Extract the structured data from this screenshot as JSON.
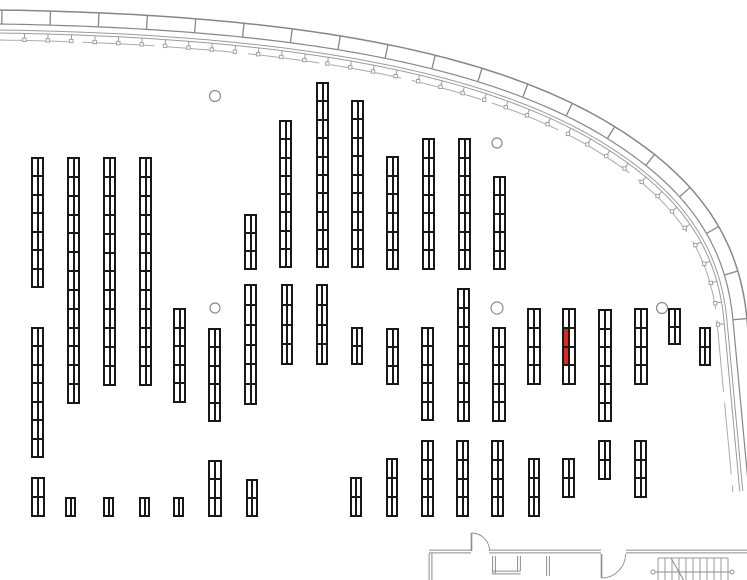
{
  "canvas": {
    "width": 747,
    "height": 580,
    "background": "#ffffff"
  },
  "colors": {
    "rack_line": "#181818",
    "highlight_red": "#dd2a1e",
    "wall_gray": "#8c8c8c",
    "facade_gray": "#878787",
    "facade_thin_gray": "#9b9b9b",
    "facade_inner_gray": "#ababab",
    "stairs_gray": "#9a9a9a"
  },
  "floorplan": {
    "racks": [
      {
        "x": 31,
        "y": 157,
        "w": 13,
        "h": 131,
        "rows": 7
      },
      {
        "x": 67,
        "y": 157,
        "w": 13,
        "h": 247,
        "rows": 13
      },
      {
        "x": 103,
        "y": 157,
        "w": 13,
        "h": 229,
        "rows": 12
      },
      {
        "x": 139,
        "y": 157,
        "w": 13,
        "h": 229,
        "rows": 12
      },
      {
        "x": 31,
        "y": 327,
        "w": 13,
        "h": 131,
        "rows": 7
      },
      {
        "x": 31,
        "y": 477,
        "w": 14,
        "h": 40,
        "rows": 2
      },
      {
        "x": 65,
        "y": 497,
        "w": 11,
        "h": 20,
        "rows": 1
      },
      {
        "x": 103,
        "y": 497,
        "w": 11,
        "h": 20,
        "rows": 1
      },
      {
        "x": 139,
        "y": 497,
        "w": 11,
        "h": 20,
        "rows": 1
      },
      {
        "x": 173,
        "y": 497,
        "w": 11,
        "h": 20,
        "rows": 1
      },
      {
        "x": 173,
        "y": 308,
        "w": 13,
        "h": 95,
        "rows": 5
      },
      {
        "x": 208,
        "y": 328,
        "w": 13,
        "h": 94,
        "rows": 5
      },
      {
        "x": 208,
        "y": 460,
        "w": 14,
        "h": 57,
        "rows": 3
      },
      {
        "x": 244,
        "y": 214,
        "w": 13,
        "h": 56,
        "rows": 3
      },
      {
        "x": 244,
        "y": 284,
        "w": 13,
        "h": 121,
        "rows": 6
      },
      {
        "x": 246,
        "y": 479,
        "w": 12,
        "h": 38,
        "rows": 2
      },
      {
        "x": 279,
        "y": 120,
        "w": 13,
        "h": 148,
        "rows": 8
      },
      {
        "x": 281,
        "y": 284,
        "w": 12,
        "h": 81,
        "rows": 4
      },
      {
        "x": 316,
        "y": 82,
        "w": 13,
        "h": 186,
        "rows": 10
      },
      {
        "x": 316,
        "y": 284,
        "w": 12,
        "h": 81,
        "rows": 4
      },
      {
        "x": 351,
        "y": 100,
        "w": 13,
        "h": 168,
        "rows": 9
      },
      {
        "x": 351,
        "y": 327,
        "w": 12,
        "h": 38,
        "rows": 2
      },
      {
        "x": 350,
        "y": 477,
        "w": 12,
        "h": 40,
        "rows": 2
      },
      {
        "x": 386,
        "y": 156,
        "w": 13,
        "h": 114,
        "rows": 6
      },
      {
        "x": 422,
        "y": 138,
        "w": 13,
        "h": 132,
        "rows": 7
      },
      {
        "x": 458,
        "y": 138,
        "w": 13,
        "h": 132,
        "rows": 7
      },
      {
        "x": 493,
        "y": 176,
        "w": 13,
        "h": 94,
        "rows": 5
      },
      {
        "x": 386,
        "y": 328,
        "w": 13,
        "h": 57,
        "rows": 3
      },
      {
        "x": 421,
        "y": 327,
        "w": 13,
        "h": 94,
        "rows": 5
      },
      {
        "x": 457,
        "y": 288,
        "w": 13,
        "h": 134,
        "rows": 7
      },
      {
        "x": 492,
        "y": 327,
        "w": 14,
        "h": 95,
        "rows": 5
      },
      {
        "x": 527,
        "y": 308,
        "w": 14,
        "h": 77,
        "rows": 4
      },
      {
        "x": 562,
        "y": 308,
        "w": 14,
        "h": 77,
        "rows": 4,
        "highlight_cells": [
          2,
          4
        ]
      },
      {
        "x": 598,
        "y": 309,
        "w": 14,
        "h": 113,
        "rows": 6
      },
      {
        "x": 634,
        "y": 308,
        "w": 14,
        "h": 77,
        "rows": 4
      },
      {
        "x": 668,
        "y": 308,
        "w": 13,
        "h": 37,
        "rows": 2
      },
      {
        "x": 699,
        "y": 327,
        "w": 12,
        "h": 39,
        "rows": 2
      },
      {
        "x": 386,
        "y": 458,
        "w": 12,
        "h": 59,
        "rows": 3
      },
      {
        "x": 421,
        "y": 440,
        "w": 13,
        "h": 77,
        "rows": 4
      },
      {
        "x": 456,
        "y": 440,
        "w": 13,
        "h": 77,
        "rows": 4
      },
      {
        "x": 491,
        "y": 440,
        "w": 13,
        "h": 77,
        "rows": 4
      },
      {
        "x": 528,
        "y": 458,
        "w": 12,
        "h": 59,
        "rows": 3
      },
      {
        "x": 562,
        "y": 458,
        "w": 13,
        "h": 40,
        "rows": 2
      },
      {
        "x": 598,
        "y": 440,
        "w": 13,
        "h": 40,
        "rows": 2
      },
      {
        "x": 634,
        "y": 440,
        "w": 13,
        "h": 58,
        "rows": 3
      }
    ],
    "columns": [
      {
        "cx": 215,
        "cy": 96,
        "r": 5.5
      },
      {
        "cx": 497,
        "cy": 143,
        "r": 5
      },
      {
        "cx": 215,
        "cy": 308,
        "r": 5
      },
      {
        "cx": 497,
        "cy": 308,
        "r": 6
      },
      {
        "cx": 662,
        "cy": 308,
        "r": 5.5
      }
    ],
    "facade": {
      "segments": [
        [
          [
            0,
            10
          ],
          [
            250,
            14
          ],
          [
            480,
            40
          ],
          [
            620,
            130
          ]
        ],
        [
          [
            620,
            130
          ],
          [
            700,
            181
          ],
          [
            740,
            240
          ],
          [
            747,
            320
          ]
        ]
      ],
      "extension": 170,
      "band_offset": 14,
      "thin_offsets": [
        20,
        23
      ],
      "inner_offset": 30,
      "mullion_spacing": 48.5,
      "tick_spacing": 23.7,
      "detail_cutoff_y": 335
    },
    "walls_double": [
      [
        429,
        551.5,
        471,
        551.5
      ],
      [
        489,
        551.5,
        601,
        551.5
      ],
      [
        626,
        551.5,
        747,
        551.5
      ],
      [
        430.5,
        553,
        430.5,
        580
      ],
      [
        494,
        556,
        494,
        574
      ],
      [
        492.5,
        572.5,
        520.5,
        572.5
      ],
      [
        519,
        556,
        519,
        571
      ],
      [
        548,
        556,
        548,
        576
      ]
    ],
    "doors": [
      {
        "leaf": [
          471.5,
          533,
          471.5,
          551
        ],
        "arc": "M 489.5 551 A 18 18 0 0 0 471.5 533"
      },
      {
        "leaf": [
          601.5,
          554,
          601.5,
          578
        ],
        "arc": "M 625.5 554 A 24 24 0 0 1 601.5 578"
      }
    ],
    "stairs": {
      "x1": 658,
      "x2": 728,
      "top": 558,
      "bottom": 580,
      "step": 7,
      "dim_line": [
        651,
        572,
        734,
        572
      ],
      "dim_dots": [
        [
          653,
          572
        ],
        [
          732,
          572
        ]
      ],
      "diagonal": [
        671,
        558,
        683.5,
        580
      ]
    }
  }
}
